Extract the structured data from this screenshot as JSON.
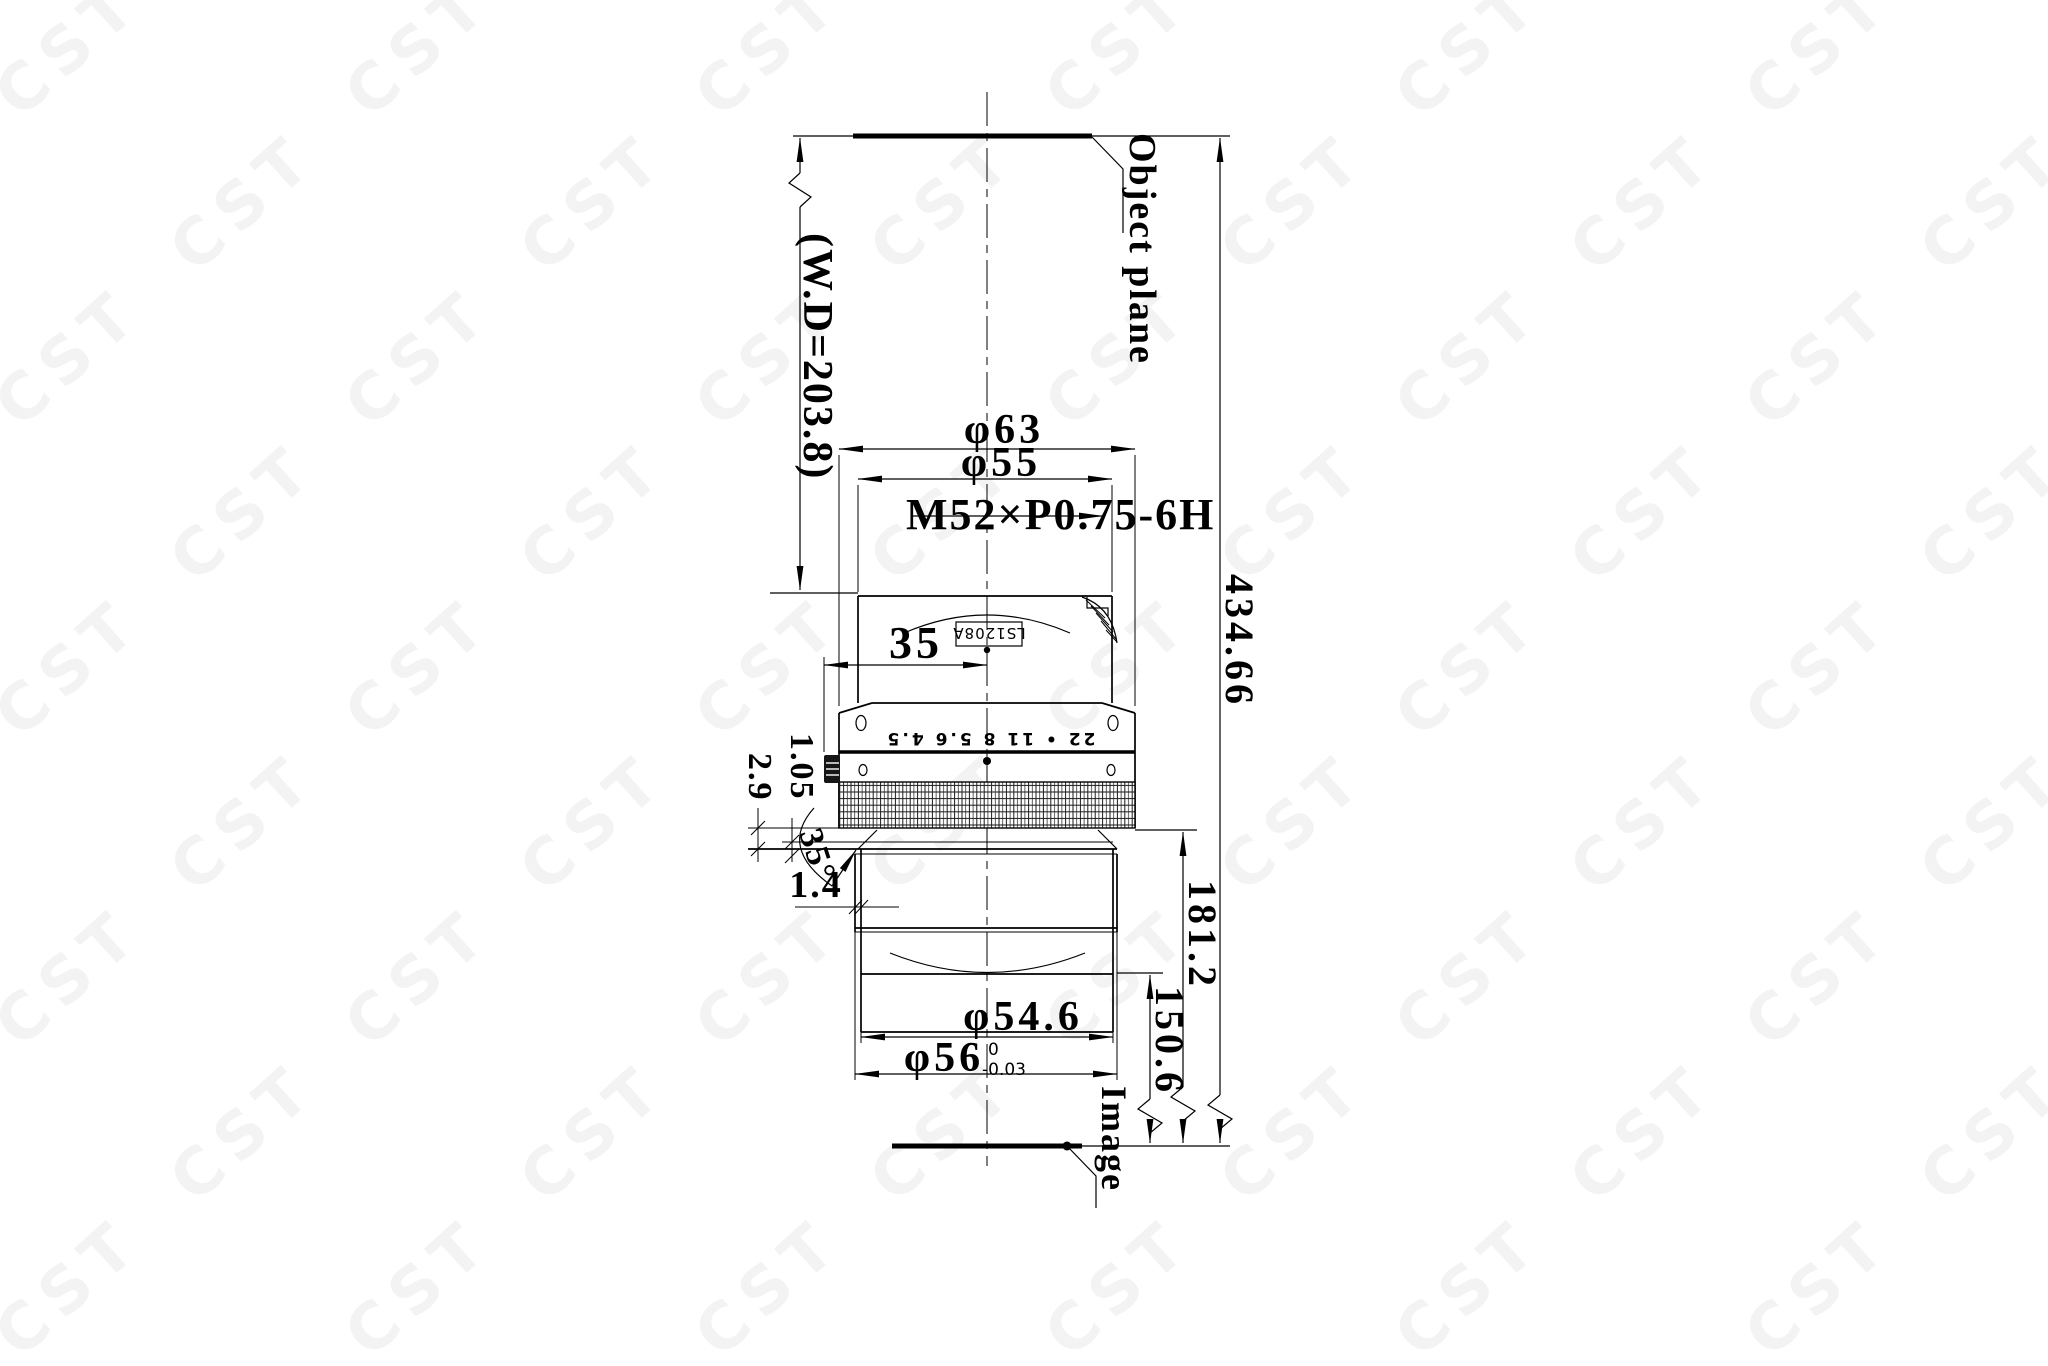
{
  "watermark": "CST",
  "labels": {
    "object_plane": "Object plane",
    "working_distance": "(W.D=203.8)",
    "dia63": "φ63",
    "dia55": "φ55",
    "thread_spec": "M52×P0.75-6H",
    "model": "LS1208A",
    "dim35": "35",
    "aperture_scale": "22 • 11 8 5.6 4.5",
    "dim105": "1.05",
    "dim29": "2.9",
    "angle35": "35°",
    "dim14": "1.4",
    "total_length": "434.66",
    "len1812": "181.2",
    "len1506": "150.6",
    "dia546": "φ54.6",
    "dia56": "φ56",
    "dia56_tol_upper": "0",
    "dia56_tol_lower": "-0.03",
    "image_plane": "Image"
  }
}
